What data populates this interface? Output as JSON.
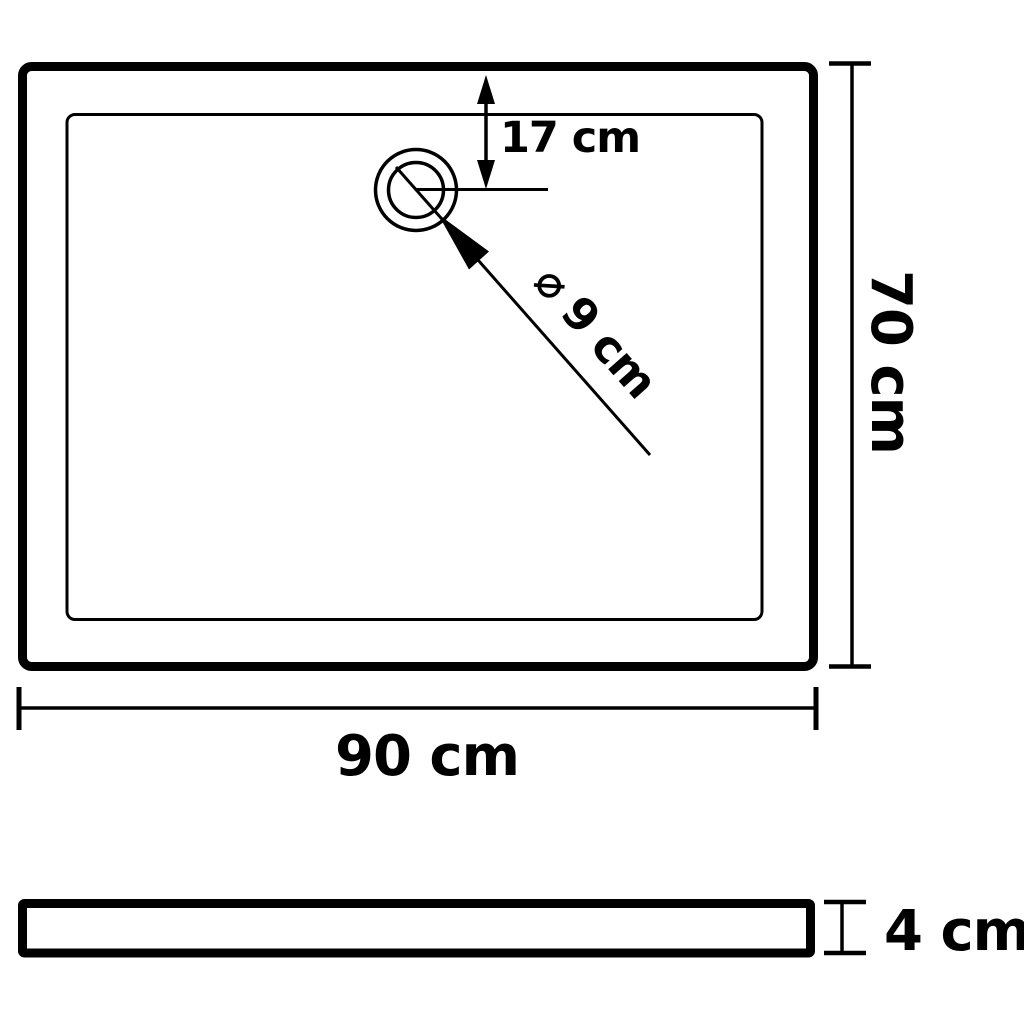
{
  "diagram": {
    "type": "technical-dimension-drawing",
    "subject": "rectangular shower base tray, top view and side profile view",
    "background_color": "#ffffff",
    "line_color": "#000000",
    "labels": {
      "drain_offset": "17 cm",
      "drain_diameter": "⌀ 9 cm",
      "depth": "70 cm",
      "width": "90 cm",
      "height": "4 cm"
    },
    "dimensions": {
      "width_cm": 90,
      "depth_cm": 70,
      "height_cm": 4,
      "drain_diameter_cm": 9,
      "drain_offset_from_top_cm": 17
    }
  }
}
